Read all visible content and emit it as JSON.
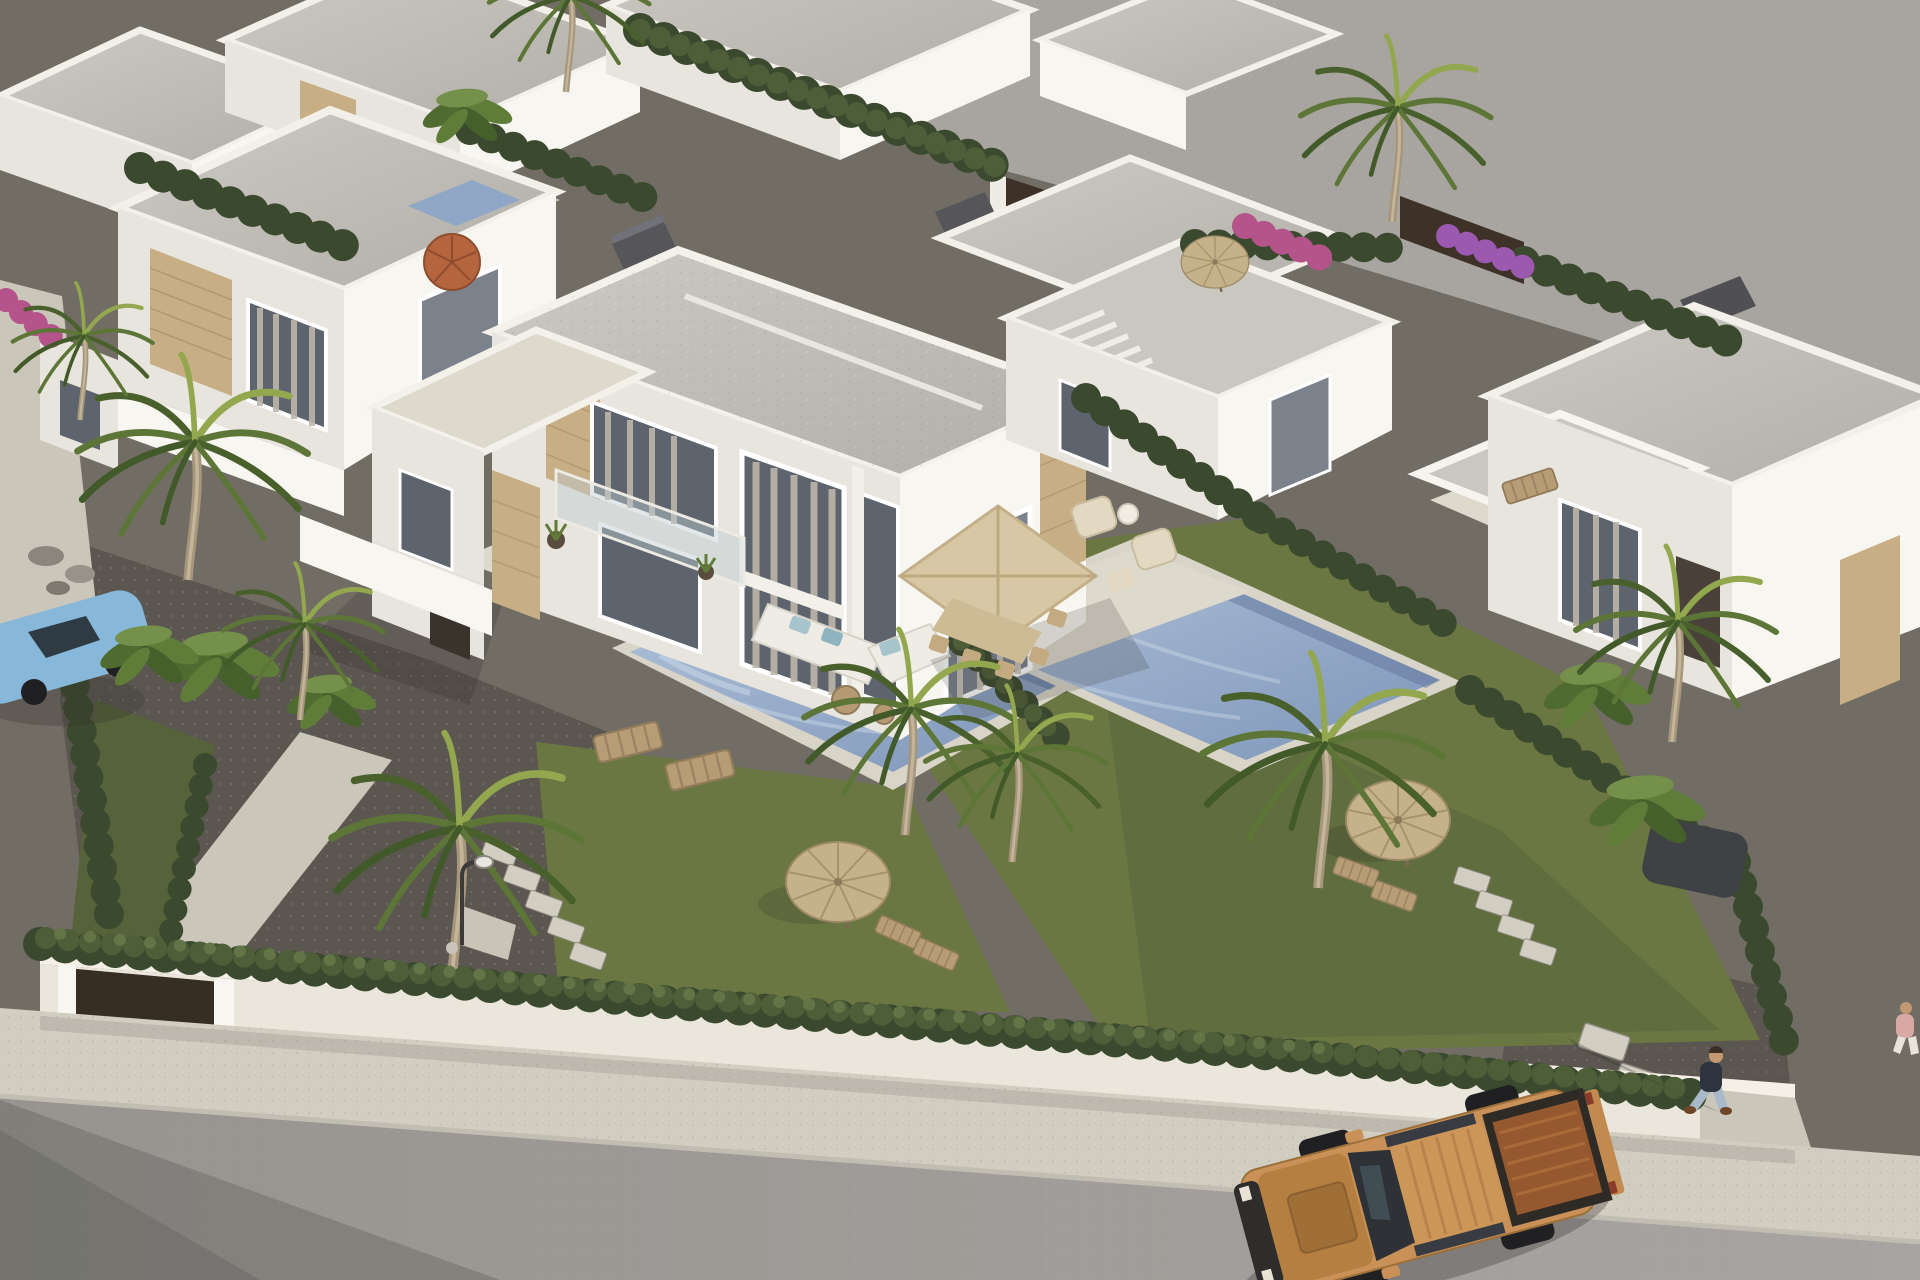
{
  "scene": {
    "kind": "3d-architectural-aerial-render",
    "subject": "Aerial view of a modern Mediterranean villa development: white flat-roof duplex villas with stone accents, private pools, lawns with thatched parasols and palm trees, perimeter wall with hedge, sidewalk and street with a tan pickup truck and a pedestrian",
    "objects": [
      "back-row-villas",
      "left-villa",
      "main-duplex-villa",
      "rear-right-villa",
      "far-right-villa",
      "left-pool",
      "right-pool",
      "neighbor-plunge-pool",
      "terrace-sofa-set",
      "terrace-dining-parasol",
      "terrace-armchairs",
      "sun-loungers",
      "thatch-parasols",
      "orange-umbrella",
      "palm-trees",
      "banana-plants",
      "hedges",
      "lawns",
      "gravel-driveway",
      "stepping-stones",
      "street-lamp",
      "perimeter-wall",
      "entrance-gate",
      "sidewalk",
      "road",
      "pickup-truck",
      "pedestrian",
      "second-pedestrian",
      "blue-car",
      "red-car",
      "dark-suv"
    ]
  },
  "colors": {
    "backdrop": "#a8a5a0",
    "ground": "#716d65",
    "gravel": "#5b5750",
    "path": "#cbc6ba",
    "grass": "#6b7743",
    "grass_shade": "#55623a",
    "hedge_dark": "#3b4a2e",
    "hedge_mid": "#4e5e39",
    "hedge_light": "#637547",
    "roof": "#bcb9b3",
    "roof_light": "#cac7c1",
    "wall_lit": "#f8f6f1",
    "wall_mid": "#e8e5de",
    "wall_shade": "#d4d1c9",
    "parapet": "#f3f0ea",
    "stone": "#c7ae85",
    "stone_dark": "#ac9164",
    "glass": "#5d646d",
    "glass_light": "#7b828c",
    "curtain": "#bdb6aa",
    "terrace": "#ded9cd",
    "coping": "#d9d4c8",
    "pool": "#8fa6c6",
    "pool_light": "#b3c4da",
    "parasol": "#d8c7a4",
    "thatch": "#c3b089",
    "umbrella_orange": "#b4653e",
    "wood": "#b59a74",
    "sofa": "#efece5",
    "cushion": "#a7c3cc",
    "wall_perimeter": "#eae6dc",
    "gate": "#362d23",
    "sidewalk": "#d2cdc1",
    "road": "#a19e9c",
    "curb": "#c2bdb2",
    "fence_dark": "#3d3128",
    "truck_body": "#c99157",
    "truck_body_dark": "#b57f42",
    "truck_bed": "#96592f",
    "truck_glass": "#2e3237",
    "tire": "#202023",
    "car_blue": "#87b8da",
    "car_red": "#8d2f26",
    "suv_dark": "#3f4245",
    "skin": "#c29873",
    "shirt": "#2d3440",
    "jeans": "#a9b9c9",
    "shoe": "#6f452a",
    "lamp": "#e9e7e0",
    "flower_pink": "#b5548b",
    "chimney": "#56565a"
  }
}
